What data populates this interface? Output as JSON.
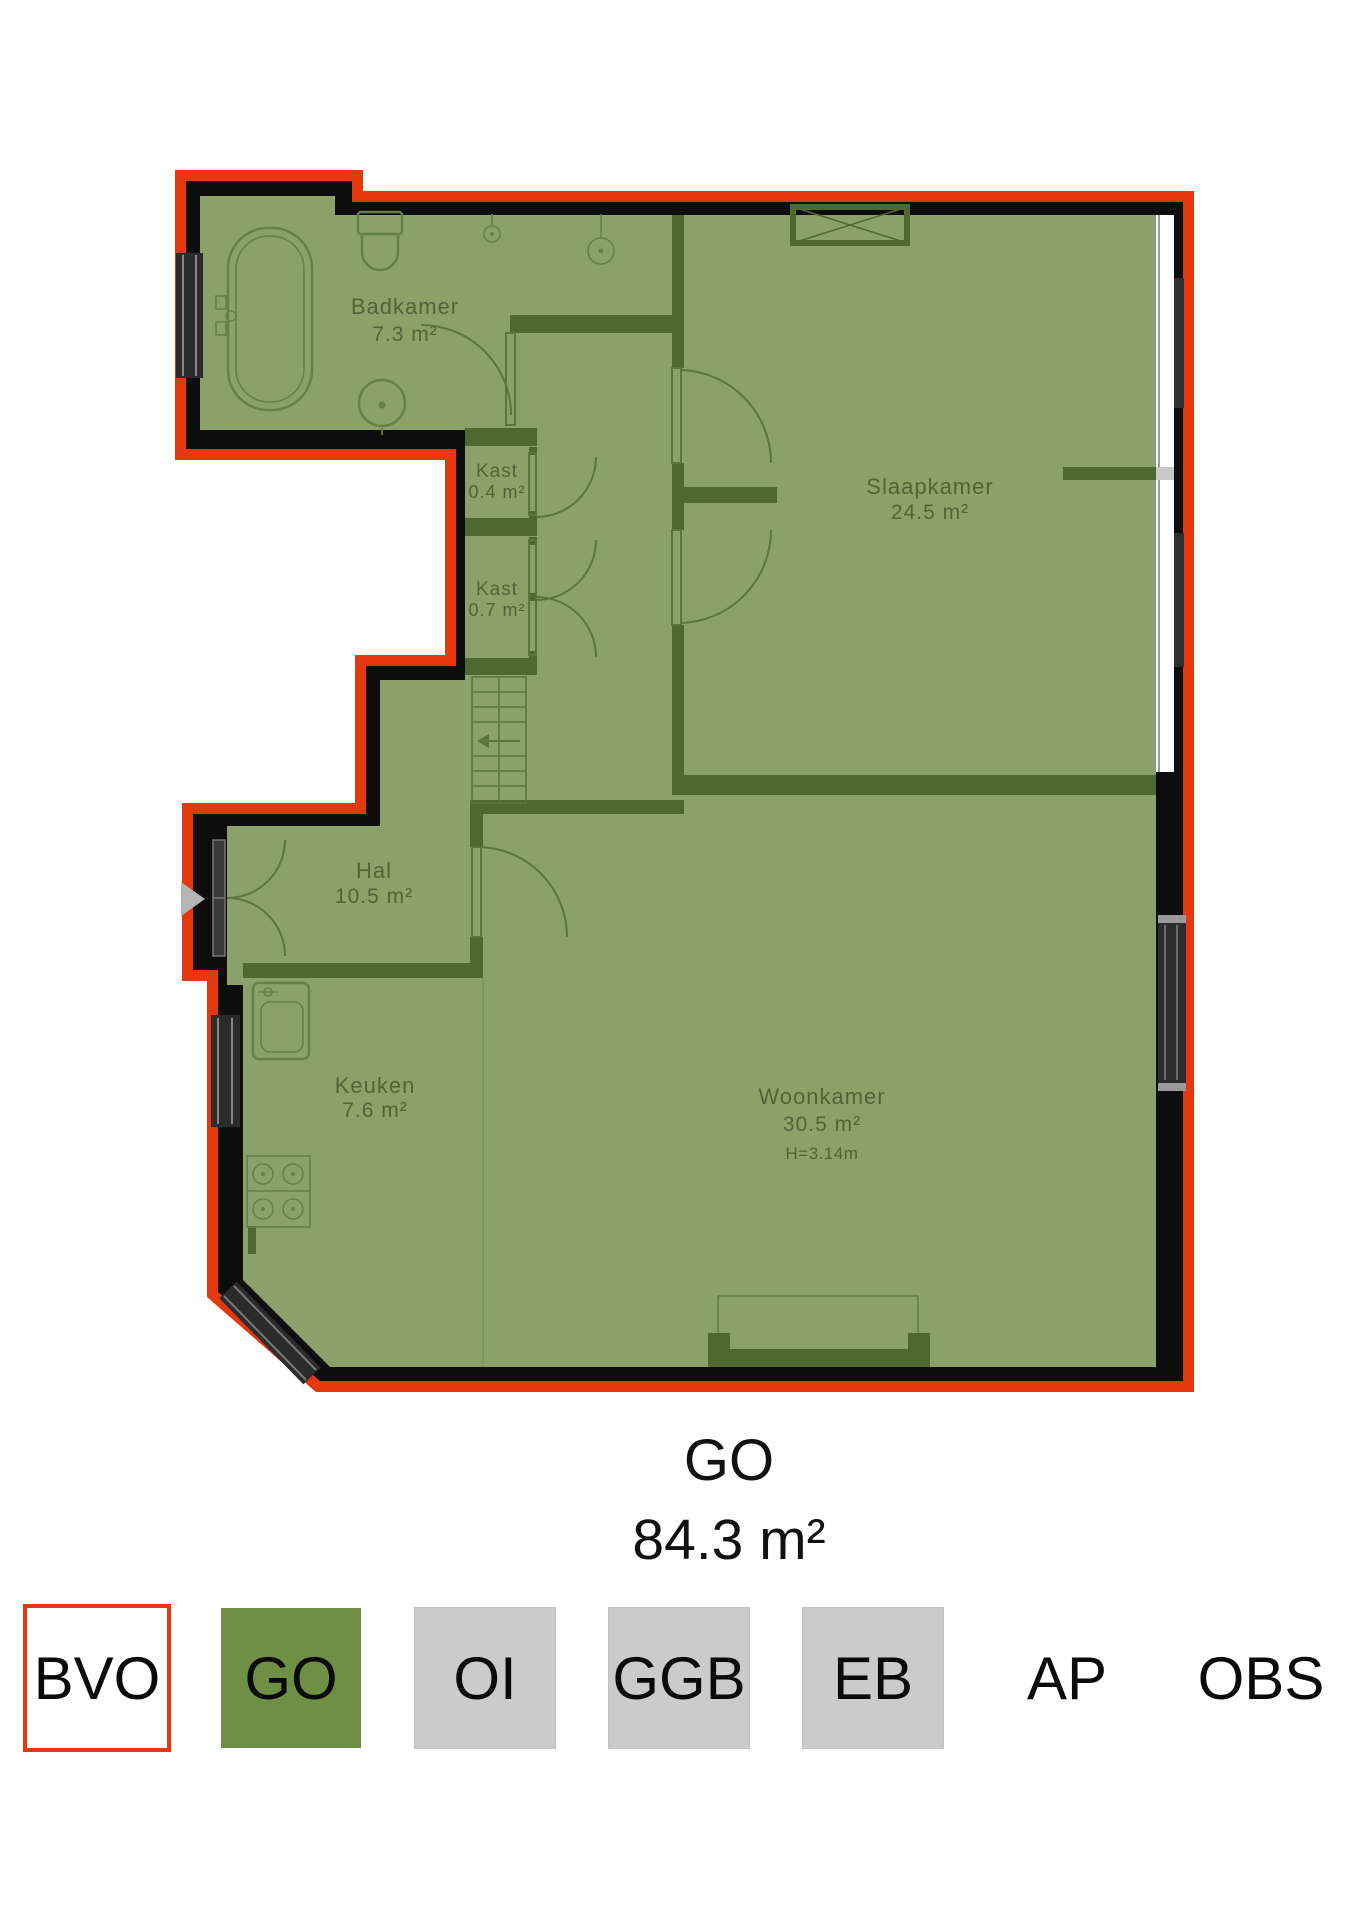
{
  "plan": {
    "rooms": [
      {
        "id": "badkamer",
        "name": "Badkamer",
        "area": "7.3 m²"
      },
      {
        "id": "kast-boven",
        "name": "Kast",
        "area": "0.4 m²"
      },
      {
        "id": "kast-onder",
        "name": "Kast",
        "area": "0.7 m²"
      },
      {
        "id": "slaapkamer",
        "name": "Slaapkamer",
        "area": "24.5 m²"
      },
      {
        "id": "hal",
        "name": "Hal",
        "area": "10.5 m²"
      },
      {
        "id": "keuken",
        "name": "Keuken",
        "area": "7.6 m²"
      },
      {
        "id": "woonkamer",
        "name": "Woonkamer",
        "area": "30.5 m²",
        "ceiling_height": "H=3.14m"
      }
    ],
    "summary": {
      "code": "GO",
      "area": "84.3 m²"
    },
    "colors": {
      "floor_green": "#8ba169",
      "interior_wall_green": "#50682f",
      "exterior_wall_black": "#0d0d0d",
      "bvo_outline_red": "#e6380f",
      "window_dark": "#2b2b2b",
      "entrance_arrow_gray": "#b5b5b5"
    }
  },
  "legend": {
    "items": [
      {
        "code": "BVO",
        "swatch": "white-red-outline"
      },
      {
        "code": "GO",
        "swatch": "green"
      },
      {
        "code": "OI",
        "swatch": "gray"
      },
      {
        "code": "GGB",
        "swatch": "gray"
      },
      {
        "code": "EB",
        "swatch": "gray"
      },
      {
        "code": "AP",
        "swatch": "none"
      },
      {
        "code": "OBS",
        "swatch": "none"
      }
    ]
  }
}
